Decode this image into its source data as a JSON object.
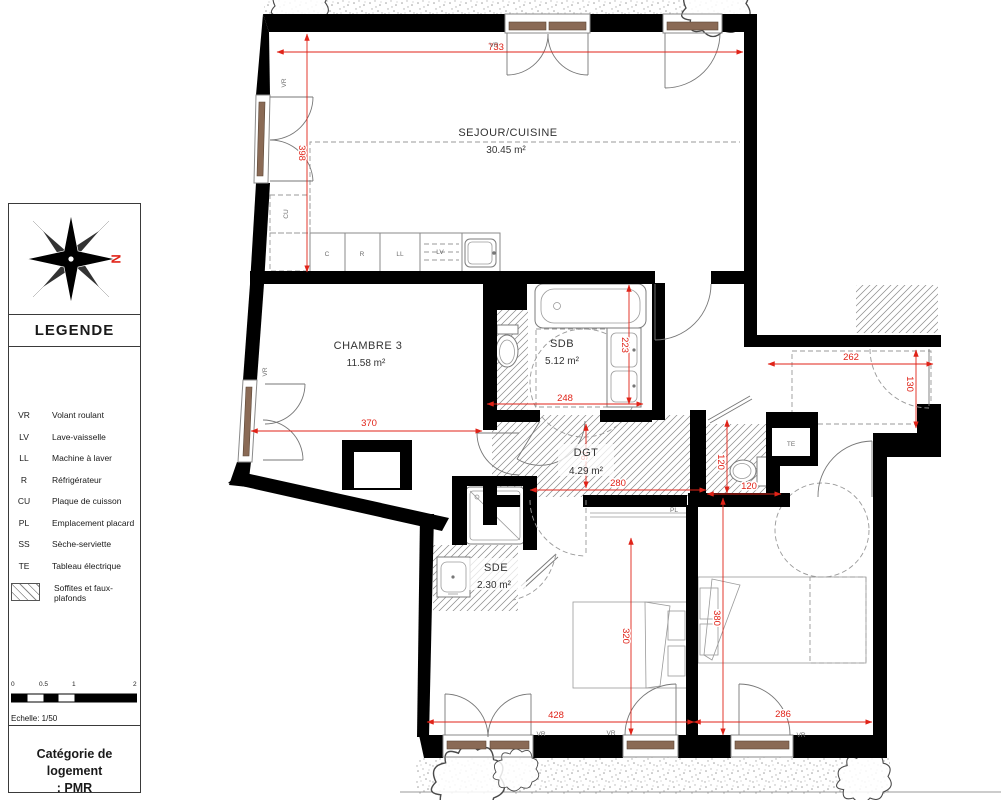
{
  "colors": {
    "dim_red": "#e02318",
    "wall_black": "#000000",
    "sill_brown": "#8a6a55"
  },
  "compass": {
    "north": "N"
  },
  "legend": {
    "title": "LEGENDE",
    "items": [
      {
        "abbr": "VR",
        "label": "Volant roulant"
      },
      {
        "abbr": "LV",
        "label": "Lave-vaisselle"
      },
      {
        "abbr": "LL",
        "label": "Machine à laver"
      },
      {
        "abbr": "R",
        "label": "Réfrigérateur"
      },
      {
        "abbr": "CU",
        "label": "Plaque de cuisson"
      },
      {
        "abbr": "PL",
        "label": "Emplacement placard"
      },
      {
        "abbr": "SS",
        "label": "Sèche-serviette"
      },
      {
        "abbr": "TE",
        "label": "Tableau électrique"
      }
    ],
    "swatch_line1": "Soffites et faux-",
    "swatch_line2": "plafonds"
  },
  "scalebar": {
    "t0": "0",
    "t1": "0.5",
    "t2": "1",
    "t3": "2",
    "label": "Echelle: 1/50"
  },
  "category": {
    "line1": "Catégorie de logement",
    "line2": ": PMR"
  },
  "rooms": {
    "sejour": {
      "name": "SEJOUR/CUISINE",
      "area": "30.45 m²"
    },
    "chambre3": {
      "name": "CHAMBRE 3",
      "area": "11.58 m²"
    },
    "sdb": {
      "name": "SDB",
      "area": "5.12 m²"
    },
    "dgt": {
      "name": "DGT",
      "area": "4.29 m²"
    },
    "sde": {
      "name": "SDE",
      "area": "2.30 m²"
    }
  },
  "dims": {
    "sejour_width": "733",
    "sejour_height": "398",
    "chambre3_width": "370",
    "sdb_width": "248",
    "sdb_height": "223",
    "entry_width": "262",
    "entry_height": "130",
    "wc_height": "120",
    "wc_width": "120",
    "dgt_width": "280",
    "dgt_door": "76",
    "room2_height": "320",
    "room2_width": "428",
    "room3_height": "380",
    "room3_width": "286"
  },
  "marks": {
    "vr": "VR",
    "te": "TE",
    "pl": "PL",
    "cu": "CU",
    "c": "C",
    "r": "R",
    "ll": "LL",
    "lv": "LV"
  }
}
